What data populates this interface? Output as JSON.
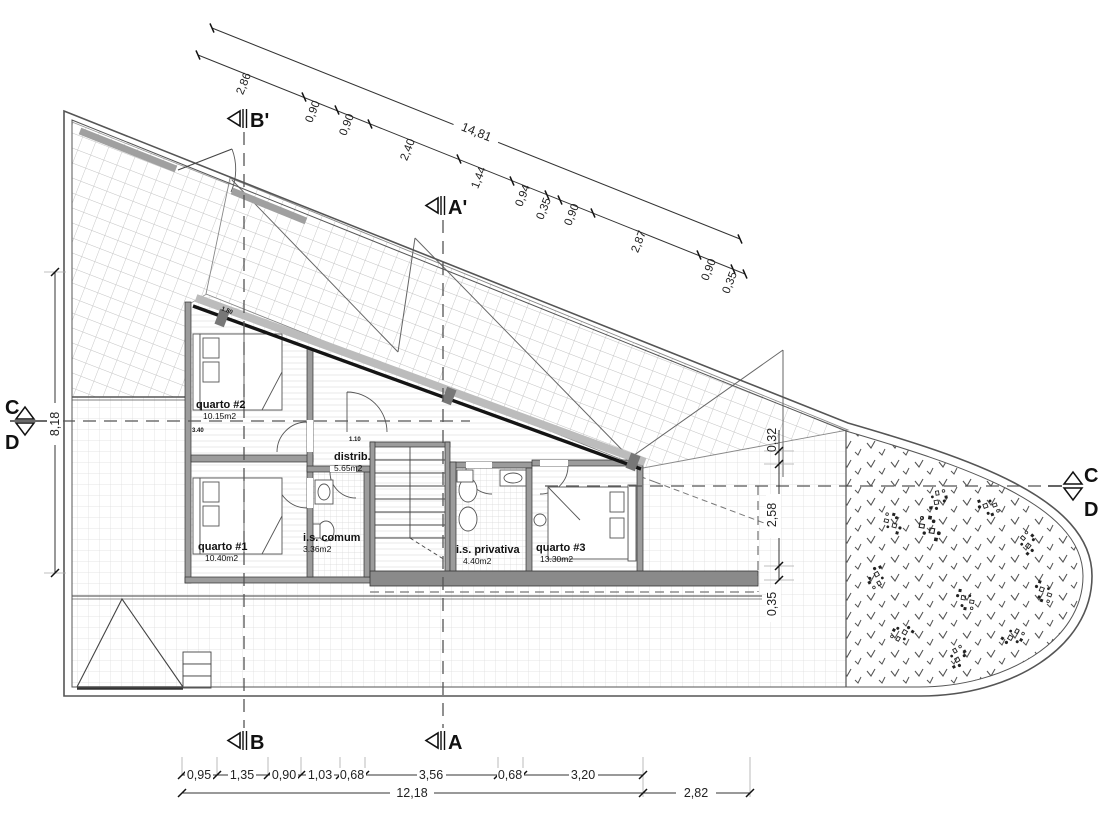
{
  "drawing": {
    "type": "architectural-floor-plan",
    "rooms": [
      {
        "name": "quarto #2",
        "area": "10.15m2"
      },
      {
        "name": "quarto #1",
        "area": "10.40m2"
      },
      {
        "name": "i.s. comum",
        "area": "3.36m2"
      },
      {
        "name": "distrib.",
        "area": "5.65m2"
      },
      {
        "name": "i.s. privativa",
        "area": "4.40m2"
      },
      {
        "name": "quarto #3",
        "area": "13.30m2"
      }
    ],
    "sections": {
      "b_top": "B'",
      "a_top": "A'",
      "b_bottom": "B",
      "a_bottom": "A",
      "c_left": "C",
      "d_left": "D",
      "c_right": "C",
      "d_right": "D"
    },
    "dimensions": {
      "top_total": "14,81",
      "top_segments": [
        "2,86",
        "0,90",
        "0,90",
        "2,40",
        "1,44",
        "0,94",
        "0,35",
        "0,90",
        "2,87",
        "0,90",
        "0,35"
      ],
      "bottom_segments": [
        "0,95",
        "1,35",
        "0,90",
        "1,03",
        "0,68",
        "3,56",
        "0,68",
        "3,20"
      ],
      "bottom_total": "12,18",
      "bottom_right": "2,82",
      "left_height": "8,18",
      "right_segments": [
        "0,32",
        "2,58",
        "0,35"
      ],
      "wall_dims": [
        "1.10",
        "3.40",
        "1.80"
      ]
    },
    "colors": {
      "wall_fill": "#9c9c9c",
      "terrace_fill": "#8a8a8a",
      "hatch": "#c6c6c6",
      "line": "#444444"
    }
  }
}
